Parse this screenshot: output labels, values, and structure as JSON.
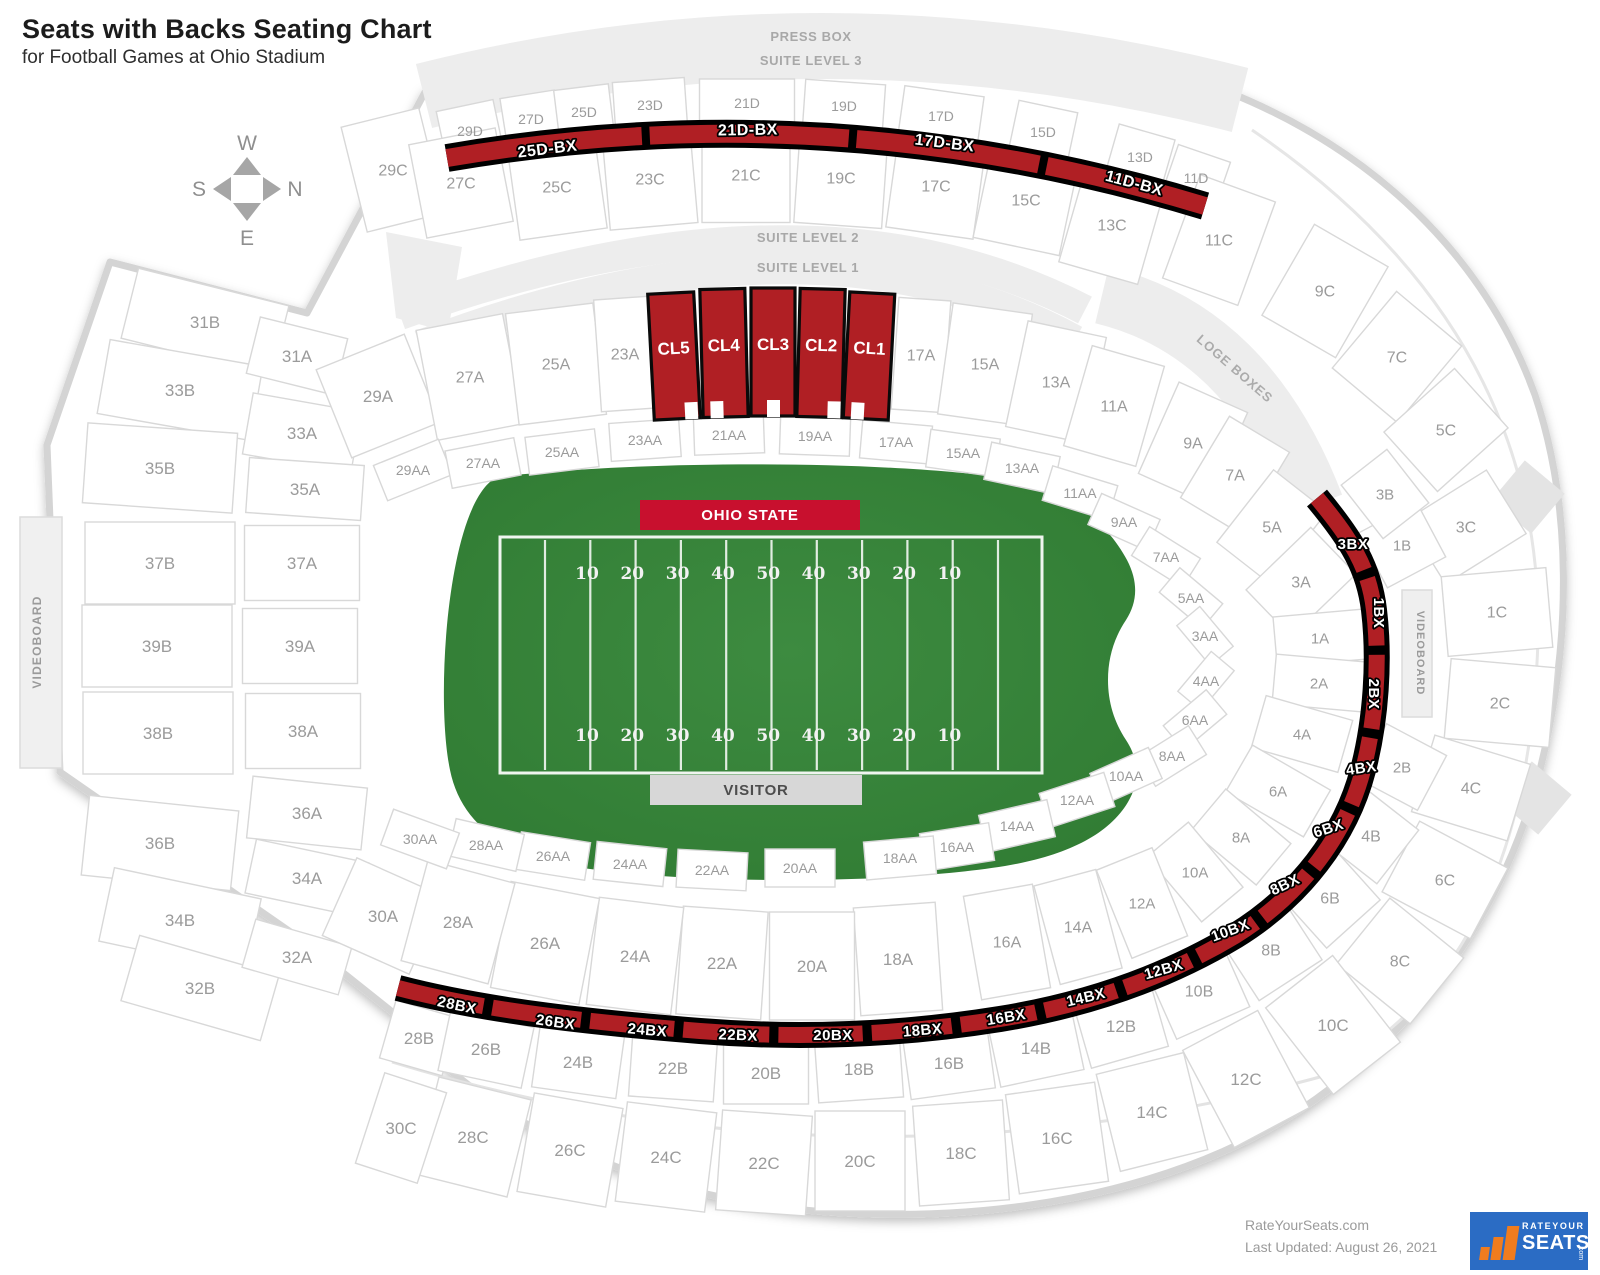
{
  "page": {
    "title": "Seats with Backs Seating Chart",
    "subtitle": "for Football Games at Ohio Stadium"
  },
  "compass": {
    "west": "W",
    "north": "N",
    "south": "S",
    "east": "E"
  },
  "stadium_labels": {
    "press_box": "PRESS BOX",
    "suite_level_3": "SUITE LEVEL 3",
    "suite_level_2": "SUITE LEVEL 2",
    "suite_level_1": "SUITE LEVEL 1",
    "loge_boxes": "LOGE BOXES",
    "videoboard_left": "VIDEOBOARD",
    "videoboard_right": "VIDEOBOARD"
  },
  "field": {
    "home_label": "OHIO STATE",
    "visitor_label": "VISITOR",
    "yard_numbers": [
      "10",
      "20",
      "30",
      "40",
      "50",
      "40",
      "30",
      "20",
      "10"
    ]
  },
  "colors": {
    "highlight_red": "#b01f24",
    "banner_red": "#c8102e",
    "banner_gray": "#d7d7d7",
    "field_green": "#3d8b40",
    "field_green_dark": "#2f7a32",
    "band_gray": "#ededed",
    "label_gray": "#9b9b9b",
    "outline_gray": "#d8d8d8",
    "logo_blue": "#2b6cc4",
    "logo_orange": "#f07c1e"
  },
  "sections": [
    [
      "29D",
      470,
      131,
      -12,
      58,
      52,
      14
    ],
    [
      "27D",
      531,
      119,
      -9,
      55,
      50,
      14
    ],
    [
      "25D",
      584,
      112,
      -7,
      55,
      50,
      14
    ],
    [
      "23D",
      650,
      105,
      -4,
      72,
      50,
      14
    ],
    [
      "21D",
      747,
      103,
      0,
      95,
      48,
      14
    ],
    [
      "19D",
      844,
      106,
      4,
      80,
      48,
      14
    ],
    [
      "17D",
      941,
      116,
      8,
      80,
      50,
      14
    ],
    [
      "15D",
      1043,
      132,
      12,
      60,
      52,
      14
    ],
    [
      "13D",
      1140,
      157,
      16,
      58,
      52,
      14
    ],
    [
      "11D",
      1196,
      178,
      19,
      55,
      52,
      14
    ],
    [
      "29C",
      393,
      170,
      -14,
      80,
      108,
      16
    ],
    [
      "27C",
      461,
      183,
      -11,
      88,
      95,
      16
    ],
    [
      "25C",
      557,
      187,
      -8,
      88,
      95,
      16
    ],
    [
      "23C",
      650,
      179,
      -5,
      88,
      95,
      16
    ],
    [
      "21C",
      746,
      175,
      0,
      88,
      95,
      16
    ],
    [
      "19C",
      841,
      178,
      4,
      88,
      95,
      16
    ],
    [
      "17C",
      936,
      186,
      8,
      88,
      95,
      16
    ],
    [
      "15C",
      1026,
      200,
      12,
      88,
      95,
      16
    ],
    [
      "13C",
      1112,
      225,
      16,
      82,
      100,
      16
    ],
    [
      "11C",
      1219,
      240,
      20,
      80,
      110,
      16
    ],
    [
      "9C",
      1325,
      291,
      30,
      85,
      105,
      16
    ],
    [
      "7C",
      1397,
      357,
      40,
      85,
      100,
      16
    ],
    [
      "5C",
      1446,
      430,
      48,
      80,
      95,
      16
    ],
    [
      "3C",
      1466,
      527,
      58,
      75,
      95,
      16
    ],
    [
      "1C",
      1497,
      612,
      -5,
      105,
      80,
      16
    ],
    [
      "2C",
      1500,
      703,
      5,
      105,
      80,
      16
    ],
    [
      "4C",
      1471,
      788,
      17,
      100,
      80,
      16
    ],
    [
      "6C",
      1445,
      880,
      28,
      100,
      80,
      16
    ],
    [
      "8C",
      1400,
      961,
      39,
      95,
      85,
      16
    ],
    [
      "10C",
      1333,
      1025,
      -38,
      85,
      110,
      17
    ],
    [
      "12C",
      1246,
      1079,
      -28,
      85,
      110,
      17
    ],
    [
      "14C",
      1152,
      1112,
      -14,
      90,
      100,
      17
    ],
    [
      "16C",
      1057,
      1138,
      -8,
      90,
      100,
      17
    ],
    [
      "18C",
      961,
      1153,
      -4,
      90,
      100,
      17
    ],
    [
      "20C",
      860,
      1161,
      0,
      90,
      100,
      17
    ],
    [
      "22C",
      764,
      1163,
      4,
      90,
      100,
      17
    ],
    [
      "24C",
      666,
      1157,
      7,
      90,
      100,
      17
    ],
    [
      "26C",
      570,
      1150,
      10,
      90,
      100,
      17
    ],
    [
      "28C",
      473,
      1137,
      14,
      95,
      100,
      17
    ],
    [
      "30C",
      401,
      1128,
      18,
      65,
      95,
      17
    ],
    [
      "31B",
      205,
      322,
      14,
      155,
      72,
      17
    ],
    [
      "33B",
      180,
      390,
      10,
      155,
      75,
      17
    ],
    [
      "35B",
      160,
      468,
      4,
      150,
      80,
      17
    ],
    [
      "37B",
      160,
      563,
      0,
      150,
      82,
      17
    ],
    [
      "39B",
      157,
      646,
      0,
      150,
      82,
      17
    ],
    [
      "38B",
      158,
      733,
      0,
      150,
      82,
      17
    ],
    [
      "36B",
      160,
      843,
      6,
      150,
      80,
      17
    ],
    [
      "34B",
      180,
      920,
      12,
      150,
      75,
      17
    ],
    [
      "32B",
      200,
      988,
      16,
      145,
      68,
      17
    ],
    [
      "28B",
      419,
      1038,
      16,
      65,
      60,
      17
    ],
    [
      "26B",
      486,
      1049,
      12,
      85,
      62,
      17
    ],
    [
      "24B",
      578,
      1062,
      8,
      85,
      62,
      17
    ],
    [
      "22B",
      673,
      1068,
      4,
      85,
      62,
      17
    ],
    [
      "20B",
      766,
      1073,
      0,
      85,
      62,
      17
    ],
    [
      "18B",
      859,
      1069,
      -4,
      85,
      62,
      17
    ],
    [
      "16B",
      949,
      1063,
      -8,
      85,
      62,
      17
    ],
    [
      "14B",
      1036,
      1048,
      -12,
      85,
      62,
      17
    ],
    [
      "12B",
      1121,
      1026,
      -16,
      80,
      65,
      17
    ],
    [
      "10B",
      1199,
      991,
      -24,
      80,
      70,
      16
    ],
    [
      "8B",
      1271,
      950,
      -33,
      75,
      72,
      16
    ],
    [
      "6B",
      1330,
      898,
      -42,
      72,
      70,
      16
    ],
    [
      "4B",
      1371,
      836,
      -52,
      68,
      68,
      16
    ],
    [
      "2B",
      1402,
      767,
      -62,
      62,
      68,
      15
    ],
    [
      "1B",
      1402,
      545,
      62,
      62,
      66,
      15
    ],
    [
      "3B",
      1385,
      494,
      52,
      68,
      58,
      15
    ],
    [
      "31A",
      297,
      356,
      14,
      90,
      58,
      17
    ],
    [
      "33A",
      302,
      433,
      10,
      110,
      62,
      17
    ],
    [
      "35A",
      305,
      489,
      4,
      115,
      55,
      17
    ],
    [
      "37A",
      302,
      563,
      0,
      115,
      75,
      17
    ],
    [
      "39A",
      300,
      646,
      0,
      115,
      75,
      17
    ],
    [
      "38A",
      303,
      731,
      0,
      115,
      75,
      17
    ],
    [
      "36A",
      307,
      813,
      6,
      115,
      62,
      17
    ],
    [
      "34A",
      307,
      878,
      12,
      115,
      55,
      17
    ],
    [
      "32A",
      297,
      957,
      16,
      100,
      50,
      17
    ],
    [
      "30A",
      383,
      916,
      24,
      95,
      85,
      17
    ],
    [
      "29A",
      378,
      396,
      -22,
      95,
      95,
      17
    ],
    [
      "27A",
      470,
      377,
      -11,
      88,
      112,
      16
    ],
    [
      "25A",
      556,
      364,
      -7,
      88,
      112,
      16
    ],
    [
      "23A",
      625,
      354,
      -4,
      55,
      112,
      16
    ],
    [
      "17A",
      921,
      355,
      4,
      52,
      112,
      16
    ],
    [
      "15A",
      985,
      364,
      8,
      80,
      112,
      16
    ],
    [
      "13A",
      1056,
      382,
      12,
      80,
      108,
      16
    ],
    [
      "11A",
      1114,
      406,
      16,
      75,
      104,
      16
    ],
    [
      "9A",
      1193,
      443,
      24,
      75,
      100,
      16
    ],
    [
      "7A",
      1235,
      475,
      31,
      70,
      95,
      16
    ],
    [
      "5A",
      1272,
      527,
      38,
      68,
      92,
      16
    ],
    [
      "3A",
      1301,
      582,
      46,
      65,
      90,
      16
    ],
    [
      "1A",
      1320,
      638,
      -5,
      90,
      50,
      15
    ],
    [
      "2A",
      1319,
      683,
      5,
      90,
      50,
      15
    ],
    [
      "4A",
      1302,
      734,
      16,
      90,
      54,
      15
    ],
    [
      "6A",
      1278,
      791,
      30,
      90,
      54,
      15
    ],
    [
      "8A",
      1241,
      837,
      40,
      85,
      54,
      15
    ],
    [
      "10A",
      1195,
      872,
      50,
      85,
      54,
      15
    ],
    [
      "12A",
      1142,
      903,
      -22,
      60,
      95,
      15
    ],
    [
      "14A",
      1078,
      927,
      -15,
      64,
      102,
      16
    ],
    [
      "16A",
      1007,
      942,
      -10,
      70,
      105,
      16
    ],
    [
      "18A",
      898,
      959,
      -4,
      82,
      108,
      17
    ],
    [
      "20A",
      812,
      966,
      0,
      85,
      108,
      17
    ],
    [
      "22A",
      722,
      963,
      4,
      85,
      108,
      17
    ],
    [
      "24A",
      635,
      956,
      7,
      85,
      108,
      17
    ],
    [
      "26A",
      545,
      943,
      11,
      90,
      108,
      17
    ],
    [
      "28A",
      458,
      922,
      15,
      90,
      104,
      17
    ],
    [
      "29AA",
      413,
      470,
      -22,
      70,
      38,
      14
    ],
    [
      "27AA",
      483,
      463,
      -11,
      70,
      38,
      14
    ],
    [
      "25AA",
      562,
      452,
      -7,
      70,
      38,
      14
    ],
    [
      "23AA",
      645,
      440,
      -4,
      70,
      38,
      14
    ],
    [
      "21AA",
      729,
      435,
      -2,
      70,
      38,
      14
    ],
    [
      "19AA",
      815,
      436,
      2,
      70,
      38,
      14
    ],
    [
      "17AA",
      896,
      442,
      5,
      70,
      38,
      14
    ],
    [
      "15AA",
      963,
      453,
      8,
      70,
      38,
      14
    ],
    [
      "13AA",
      1022,
      468,
      12,
      70,
      38,
      14
    ],
    [
      "11AA",
      1080,
      493,
      17,
      68,
      36,
      14
    ],
    [
      "9AA",
      1124,
      522,
      24,
      64,
      34,
      14
    ],
    [
      "7AA",
      1166,
      557,
      32,
      60,
      34,
      14
    ],
    [
      "5AA",
      1191,
      598,
      40,
      56,
      32,
      14
    ],
    [
      "3AA",
      1205,
      636,
      50,
      52,
      30,
      14
    ],
    [
      "4AA",
      1206,
      681,
      -50,
      52,
      30,
      14
    ],
    [
      "6AA",
      1195,
      720,
      -40,
      56,
      32,
      14
    ],
    [
      "8AA",
      1172,
      756,
      -32,
      60,
      34,
      14
    ],
    [
      "10AA",
      1126,
      776,
      -24,
      64,
      34,
      14
    ],
    [
      "12AA",
      1077,
      800,
      -18,
      68,
      36,
      14
    ],
    [
      "14AA",
      1017,
      826,
      -13,
      70,
      38,
      14
    ],
    [
      "16AA",
      957,
      847,
      -9,
      70,
      38,
      14
    ],
    [
      "18AA",
      900,
      858,
      -5,
      70,
      38,
      14
    ],
    [
      "20AA",
      800,
      868,
      0,
      70,
      38,
      14
    ],
    [
      "22AA",
      712,
      870,
      3,
      70,
      38,
      14
    ],
    [
      "24AA",
      630,
      864,
      6,
      70,
      38,
      14
    ],
    [
      "26AA",
      553,
      856,
      9,
      70,
      38,
      14
    ],
    [
      "28AA",
      486,
      845,
      13,
      70,
      38,
      14
    ],
    [
      "30AA",
      420,
      839,
      20,
      70,
      38,
      14
    ]
  ],
  "club_sections": [
    [
      "CL5",
      674,
      356,
      -3,
      46,
      126
    ],
    [
      "CL4",
      724,
      353,
      -1.5,
      45,
      128
    ],
    [
      "CL3",
      773,
      352,
      0,
      44,
      128
    ],
    [
      "CL2",
      821,
      353,
      1.5,
      45,
      128
    ],
    [
      "CL1",
      869,
      356,
      3,
      45,
      126
    ]
  ],
  "bx_top": [
    [
      "25D-BX",
      548,
      148,
      -7
    ],
    [
      "21D-BX",
      748,
      129,
      -1
    ],
    [
      "17D-BX",
      944,
      142,
      7
    ],
    [
      "11D-BX",
      1133,
      182,
      15
    ]
  ],
  "bx_arc": [
    [
      "3BX",
      1353,
      543,
      0
    ],
    [
      "1BX",
      1374,
      607,
      90
    ],
    [
      "2BX",
      1369,
      688,
      90
    ],
    [
      "4BX",
      1362,
      767,
      -8
    ],
    [
      "6BX",
      1330,
      827,
      -18
    ],
    [
      "8BX",
      1287,
      883,
      -25
    ],
    [
      "10BX",
      1232,
      929,
      -20
    ],
    [
      "12BX",
      1165,
      968,
      -16
    ],
    [
      "14BX",
      1087,
      996,
      -13
    ],
    [
      "16BX",
      1007,
      1016,
      -9
    ],
    [
      "18BX",
      923,
      1029,
      -5
    ],
    [
      "20BX",
      833,
      1034,
      0
    ],
    [
      "22BX",
      738,
      1034,
      2
    ],
    [
      "24BX",
      647,
      1029,
      5
    ],
    [
      "26BX",
      555,
      1021,
      8
    ],
    [
      "28BX",
      456,
      1004,
      12
    ]
  ],
  "footer": {
    "site": "RateYourSeats.com",
    "updated": "Last Updated: August 26, 2021",
    "logo_top": "RATEYOUR",
    "logo_bottom": "SEATS",
    "logo_com": ".com"
  }
}
